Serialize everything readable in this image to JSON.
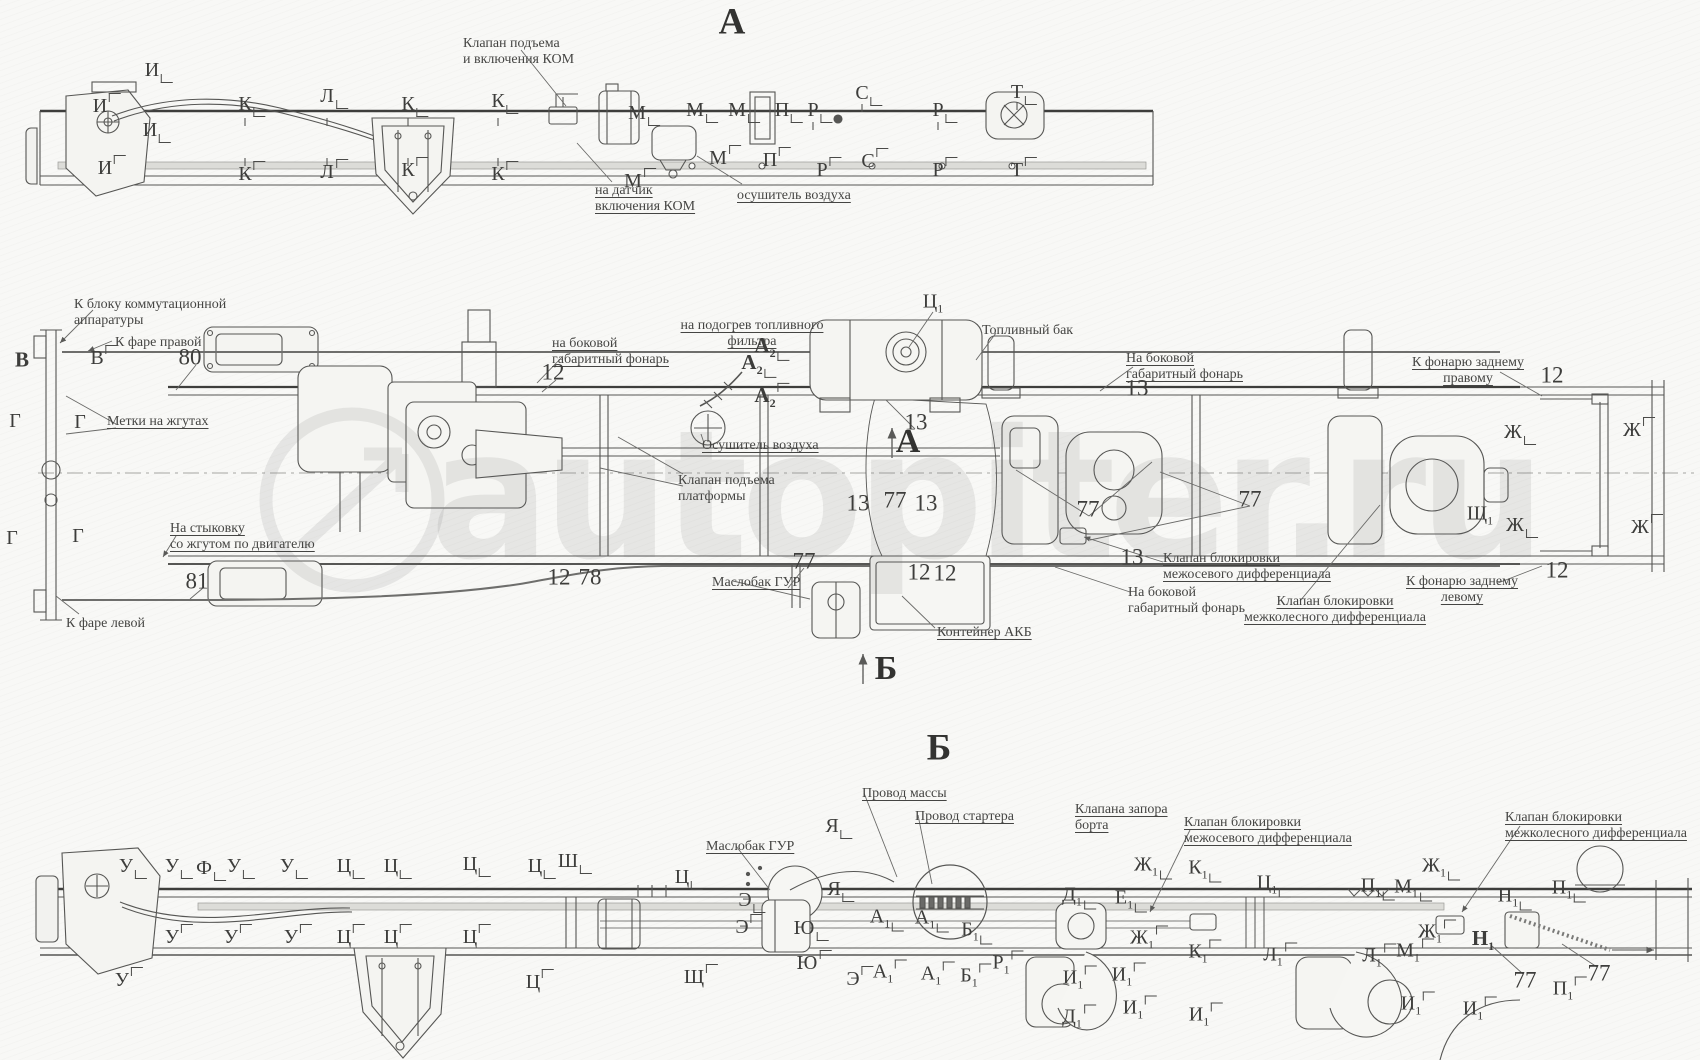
{
  "watermark": {
    "text": "autopiter.ru"
  },
  "headings": [
    {
      "id": "view-a-heading",
      "text": "А",
      "x": 732,
      "y": 22
    },
    {
      "id": "view-b-heading",
      "text": "Б",
      "x": 939,
      "y": 748
    }
  ],
  "section_markers": [
    {
      "id": "section-arrow-a",
      "text": "А",
      "x": 908,
      "y": 442
    },
    {
      "id": "section-arrow-b",
      "text": "Б",
      "x": 886,
      "y": 669
    }
  ],
  "annotations": [
    {
      "id": "kom-valve-label",
      "text": "Клапан подъема\nи включения КОМ",
      "x": 463,
      "y": 36
    },
    {
      "id": "kom-sensor-label",
      "text": "на датчик\nвключения КОМ",
      "x": 595,
      "y": 183,
      "u": true
    },
    {
      "id": "air-dryer-label-top",
      "text": "осушитель воздуха",
      "x": 737,
      "y": 188,
      "u": true
    },
    {
      "id": "switchgear-block-label",
      "text": "К блоку коммутационной\nаппаратуры",
      "x": 74,
      "y": 297
    },
    {
      "id": "right-headlamp-label",
      "text": "К фаре правой",
      "x": 115,
      "y": 335
    },
    {
      "id": "harness-marks-label",
      "text": "Метки на жгутах",
      "x": 107,
      "y": 414,
      "u": true
    },
    {
      "id": "side-lamp-label-front",
      "text": "на боковой\nгабаритный фонарь",
      "x": 552,
      "y": 336,
      "u": true
    },
    {
      "id": "fuel-filter-heater-label",
      "text": "на подогрев топливного\nфильтра",
      "x": 752,
      "y": 318,
      "u": true,
      "align": "center"
    },
    {
      "id": "fuel-tank-label",
      "text": "Топливный бак",
      "x": 982,
      "y": 323
    },
    {
      "id": "side-lamp-label-right",
      "text": "На боковой\nгабаритный фонарь",
      "x": 1126,
      "y": 351,
      "u": true
    },
    {
      "id": "rear-lamp-right-label",
      "text": "К фонарю заднему\nправому",
      "x": 1468,
      "y": 355,
      "u": true,
      "align": "center"
    },
    {
      "id": "air-dryer-label-side",
      "text": "Осушитель воздуха",
      "x": 702,
      "y": 438,
      "u": true
    },
    {
      "id": "platform-valve-label",
      "text": "Клапан подъема\nплатформы",
      "x": 678,
      "y": 473
    },
    {
      "id": "gur-tank-label-side",
      "text": "Маслобак ГУР",
      "x": 712,
      "y": 575,
      "u": true
    },
    {
      "id": "battery-box-label",
      "text": "Контейнер АКБ",
      "x": 937,
      "y": 625,
      "u": true
    },
    {
      "id": "interaxle-diff-valve-label-side",
      "text": "Клапан блокировки\nмежосевого дифференциала",
      "x": 1163,
      "y": 551,
      "u": true
    },
    {
      "id": "side-lamp-label-rear",
      "text": "На боковой\nгабаритный фонарь",
      "x": 1128,
      "y": 585
    },
    {
      "id": "interwheel-diff-valve-label-side",
      "text": "Клапан блокировки\nмежколесного дифференциала",
      "x": 1335,
      "y": 594,
      "u": true,
      "align": "center"
    },
    {
      "id": "rear-lamp-left-label",
      "text": "К фонарю заднему\nлевому",
      "x": 1462,
      "y": 574,
      "u": true,
      "align": "center"
    },
    {
      "id": "engine-harness-label",
      "text": "На стыковку\nсо жгутом по двигателю",
      "x": 170,
      "y": 521,
      "u": true
    },
    {
      "id": "left-headlamp-label",
      "text": "К фаре левой",
      "x": 66,
      "y": 616
    },
    {
      "id": "ground-wire-label",
      "text": "Провод массы",
      "x": 862,
      "y": 786,
      "u": true
    },
    {
      "id": "starter-wire-label",
      "text": "Провод стартера",
      "x": 915,
      "y": 809,
      "u": true
    },
    {
      "id": "board-lock-valve-label",
      "text": "Клапана запора\nборта",
      "x": 1075,
      "y": 802,
      "u": true
    },
    {
      "id": "interaxle-diff-valve-label-b",
      "text": "Клапан блокировки\nмежосевого дифференциала",
      "x": 1184,
      "y": 815,
      "u": true
    },
    {
      "id": "interwheel-diff-valve-label-b",
      "text": "Клапан блокировки\nмежколесного дифференциала",
      "x": 1505,
      "y": 810,
      "u": true
    },
    {
      "id": "gur-tank-label-b",
      "text": "Маслобак ГУР",
      "x": 706,
      "y": 839,
      "u": true
    }
  ],
  "callouts": [
    {
      "t": "И",
      "x": 152,
      "y": 70,
      "c": "d"
    },
    {
      "t": "И",
      "x": 100,
      "y": 106,
      "c": "u"
    },
    {
      "t": "И",
      "x": 150,
      "y": 130,
      "c": "d"
    },
    {
      "t": "И",
      "x": 105,
      "y": 168,
      "c": "u"
    },
    {
      "t": "К",
      "x": 245,
      "y": 104,
      "c": "d"
    },
    {
      "t": "К",
      "x": 245,
      "y": 174,
      "c": "u"
    },
    {
      "t": "Л",
      "x": 327,
      "y": 96,
      "c": "d"
    },
    {
      "t": "Л",
      "x": 327,
      "y": 172,
      "c": "u"
    },
    {
      "t": "К",
      "x": 408,
      "y": 104,
      "c": "d"
    },
    {
      "t": "К",
      "x": 408,
      "y": 170,
      "c": "u"
    },
    {
      "t": "К",
      "x": 498,
      "y": 101,
      "c": "d"
    },
    {
      "t": "К",
      "x": 498,
      "y": 174,
      "c": "u"
    },
    {
      "t": "М",
      "x": 637,
      "y": 113,
      "c": "d"
    },
    {
      "t": "М",
      "x": 633,
      "y": 181,
      "c": "u"
    },
    {
      "t": "М",
      "x": 695,
      "y": 110,
      "c": "d"
    },
    {
      "t": "М",
      "x": 718,
      "y": 158,
      "c": "u"
    },
    {
      "t": "М",
      "x": 737,
      "y": 110,
      "c": "d"
    },
    {
      "t": "П",
      "x": 782,
      "y": 110,
      "c": "d"
    },
    {
      "t": "П",
      "x": 770,
      "y": 160,
      "c": "u"
    },
    {
      "t": "Р",
      "x": 813,
      "y": 110,
      "c": "d"
    },
    {
      "t": "Р",
      "x": 822,
      "y": 170,
      "c": "u"
    },
    {
      "t": "С",
      "x": 862,
      "y": 93,
      "c": "d"
    },
    {
      "t": "С",
      "x": 868,
      "y": 161,
      "c": "u"
    },
    {
      "t": "Р",
      "x": 938,
      "y": 110,
      "c": "d"
    },
    {
      "t": "Р",
      "x": 938,
      "y": 170,
      "c": "u"
    },
    {
      "t": "Т",
      "x": 1017,
      "y": 92,
      "c": "d"
    },
    {
      "t": "Т",
      "x": 1017,
      "y": 170,
      "c": "u"
    },
    {
      "t": "В",
      "x": 22,
      "y": 360,
      "b": 1
    },
    {
      "t": "В",
      "x": 97,
      "y": 358,
      "c": "u"
    },
    {
      "t": "Г",
      "x": 15,
      "y": 421
    },
    {
      "t": "Г",
      "x": 80,
      "y": 422
    },
    {
      "t": "Г",
      "x": 12,
      "y": 538
    },
    {
      "t": "Г",
      "x": 78,
      "y": 536
    },
    {
      "t": "А",
      "s": "2",
      "b": 1,
      "x": 765,
      "y": 347,
      "c": "d"
    },
    {
      "t": "А",
      "s": "2",
      "b": 1,
      "x": 752,
      "y": 364,
      "c": "d"
    },
    {
      "t": "А",
      "s": "2",
      "b": 1,
      "x": 765,
      "y": 397,
      "c": "u"
    },
    {
      "t": "Ц",
      "s": "1",
      "x": 933,
      "y": 303
    },
    {
      "t": "Ж",
      "x": 1513,
      "y": 432,
      "c": "d"
    },
    {
      "t": "Ж",
      "x": 1632,
      "y": 430,
      "c": "u"
    },
    {
      "t": "Ж",
      "x": 1515,
      "y": 525,
      "c": "d"
    },
    {
      "t": "Ж",
      "x": 1640,
      "y": 527,
      "c": "u"
    },
    {
      "t": "Щ",
      "s": "1",
      "x": 1480,
      "y": 515
    },
    {
      "t": "80",
      "x": 190,
      "y": 357
    },
    {
      "t": "81",
      "x": 197,
      "y": 581
    },
    {
      "t": "12",
      "x": 553,
      "y": 372
    },
    {
      "t": "12",
      "x": 1552,
      "y": 375
    },
    {
      "t": "12",
      "x": 1557,
      "y": 570
    },
    {
      "t": "12",
      "x": 919,
      "y": 572
    },
    {
      "t": "12",
      "x": 945,
      "y": 573
    },
    {
      "t": "12",
      "x": 559,
      "y": 577
    },
    {
      "t": "78",
      "x": 590,
      "y": 577
    },
    {
      "t": "13",
      "x": 916,
      "y": 422
    },
    {
      "t": "13",
      "x": 858,
      "y": 503
    },
    {
      "t": "13",
      "x": 926,
      "y": 503
    },
    {
      "t": "13",
      "x": 1137,
      "y": 388
    },
    {
      "t": "13",
      "x": 1132,
      "y": 557
    },
    {
      "t": "77",
      "x": 895,
      "y": 500
    },
    {
      "t": "77",
      "x": 1088,
      "y": 509
    },
    {
      "t": "77",
      "x": 1250,
      "y": 499
    },
    {
      "t": "77",
      "x": 804,
      "y": 561
    },
    {
      "t": "У",
      "x": 126,
      "y": 866,
      "c": "d"
    },
    {
      "t": "У",
      "x": 172,
      "y": 866,
      "c": "d"
    },
    {
      "t": "Ф",
      "x": 204,
      "y": 868,
      "c": "d"
    },
    {
      "t": "У",
      "x": 234,
      "y": 866,
      "c": "d"
    },
    {
      "t": "У",
      "x": 287,
      "y": 866,
      "c": "d"
    },
    {
      "t": "Ц",
      "x": 344,
      "y": 866,
      "c": "d"
    },
    {
      "t": "Ц",
      "x": 391,
      "y": 866,
      "c": "d"
    },
    {
      "t": "Ц",
      "x": 470,
      "y": 864,
      "c": "d"
    },
    {
      "t": "Ц",
      "x": 535,
      "y": 866,
      "c": "d"
    },
    {
      "t": "Ш",
      "x": 568,
      "y": 861,
      "c": "d"
    },
    {
      "t": "Ц",
      "x": 682,
      "y": 877,
      "c": "d"
    },
    {
      "t": "У",
      "x": 172,
      "y": 937,
      "c": "u"
    },
    {
      "t": "У",
      "x": 231,
      "y": 937,
      "c": "u"
    },
    {
      "t": "У",
      "x": 291,
      "y": 937,
      "c": "u"
    },
    {
      "t": "Ц",
      "x": 344,
      "y": 937,
      "c": "u"
    },
    {
      "t": "Ц",
      "x": 391,
      "y": 937,
      "c": "u"
    },
    {
      "t": "Ц",
      "x": 470,
      "y": 937,
      "c": "u"
    },
    {
      "t": "У",
      "x": 122,
      "y": 980,
      "c": "u"
    },
    {
      "t": "Ц",
      "x": 533,
      "y": 982,
      "c": "u"
    },
    {
      "t": "Щ",
      "x": 694,
      "y": 977,
      "c": "u"
    },
    {
      "t": "Я",
      "x": 832,
      "y": 826,
      "c": "d"
    },
    {
      "t": "Я",
      "x": 834,
      "y": 889,
      "c": "d"
    },
    {
      "t": "Э",
      "x": 745,
      "y": 900,
      "c": "d"
    },
    {
      "t": "Э",
      "x": 742,
      "y": 927,
      "c": "u"
    },
    {
      "t": "Ю",
      "x": 804,
      "y": 928,
      "c": "d"
    },
    {
      "t": "Ю",
      "x": 807,
      "y": 963,
      "c": "u"
    },
    {
      "t": "Э",
      "x": 853,
      "y": 979,
      "c": "u"
    },
    {
      "t": "А",
      "s": "1",
      "x": 880,
      "y": 918,
      "c": "d"
    },
    {
      "t": "А",
      "s": "1",
      "x": 925,
      "y": 919,
      "c": "d"
    },
    {
      "t": "Б",
      "s": "1",
      "x": 970,
      "y": 931,
      "c": "d"
    },
    {
      "t": "А",
      "s": "1",
      "x": 883,
      "y": 973,
      "c": "u"
    },
    {
      "t": "А",
      "s": "1",
      "x": 931,
      "y": 975,
      "c": "u"
    },
    {
      "t": "Б",
      "s": "1",
      "x": 969,
      "y": 977,
      "c": "u"
    },
    {
      "t": "Р",
      "s": "1",
      "x": 1001,
      "y": 964,
      "c": "u"
    },
    {
      "t": "Д",
      "s": "1",
      "x": 1072,
      "y": 896,
      "c": "d"
    },
    {
      "t": "Е",
      "s": "1",
      "x": 1124,
      "y": 899,
      "c": "d"
    },
    {
      "t": "Ж",
      "s": "1",
      "x": 1146,
      "y": 866,
      "c": "d"
    },
    {
      "t": "К",
      "s": "1",
      "x": 1198,
      "y": 869,
      "c": "d"
    },
    {
      "t": "Ц",
      "s": "1",
      "x": 1267,
      "y": 884,
      "c": "d"
    },
    {
      "t": "П",
      "s": "1",
      "x": 1371,
      "y": 887,
      "c": "d"
    },
    {
      "t": "М",
      "s": "1",
      "x": 1406,
      "y": 888,
      "c": "d"
    },
    {
      "t": "Ж",
      "s": "1",
      "x": 1434,
      "y": 867,
      "c": "d"
    },
    {
      "t": "Н",
      "s": "1",
      "x": 1508,
      "y": 897,
      "c": "d"
    },
    {
      "t": "П",
      "s": "1",
      "x": 1562,
      "y": 889,
      "c": "d"
    },
    {
      "t": "Ж",
      "s": "1",
      "x": 1142,
      "y": 939,
      "c": "u"
    },
    {
      "t": "К",
      "s": "1",
      "x": 1198,
      "y": 953,
      "c": "u"
    },
    {
      "t": "Л",
      "s": "1",
      "x": 1273,
      "y": 956,
      "c": "u"
    },
    {
      "t": "Л",
      "s": "1",
      "x": 1372,
      "y": 957,
      "c": "u"
    },
    {
      "t": "М",
      "s": "1",
      "x": 1408,
      "y": 952,
      "c": "u"
    },
    {
      "t": "Ж",
      "s": "1",
      "x": 1430,
      "y": 933,
      "c": "u"
    },
    {
      "t": "Н",
      "s": "1",
      "x": 1483,
      "y": 940,
      "b": 1
    },
    {
      "t": "И",
      "s": "1",
      "x": 1073,
      "y": 979,
      "c": "u"
    },
    {
      "t": "И",
      "s": "1",
      "x": 1122,
      "y": 976,
      "c": "u"
    },
    {
      "t": "И",
      "s": "1",
      "x": 1133,
      "y": 1009,
      "c": "u"
    },
    {
      "t": "И",
      "s": "1",
      "x": 1199,
      "y": 1016,
      "c": "u"
    },
    {
      "t": "Д",
      "s": "1",
      "x": 1072,
      "y": 1018,
      "c": "u"
    },
    {
      "t": "И",
      "s": "1",
      "x": 1411,
      "y": 1005,
      "c": "u"
    },
    {
      "t": "И",
      "s": "1",
      "x": 1473,
      "y": 1010,
      "c": "u"
    },
    {
      "t": "77",
      "x": 1525,
      "y": 980
    },
    {
      "t": "77",
      "x": 1599,
      "y": 973
    },
    {
      "t": "П",
      "s": "1",
      "x": 1563,
      "y": 990,
      "c": "u"
    }
  ]
}
